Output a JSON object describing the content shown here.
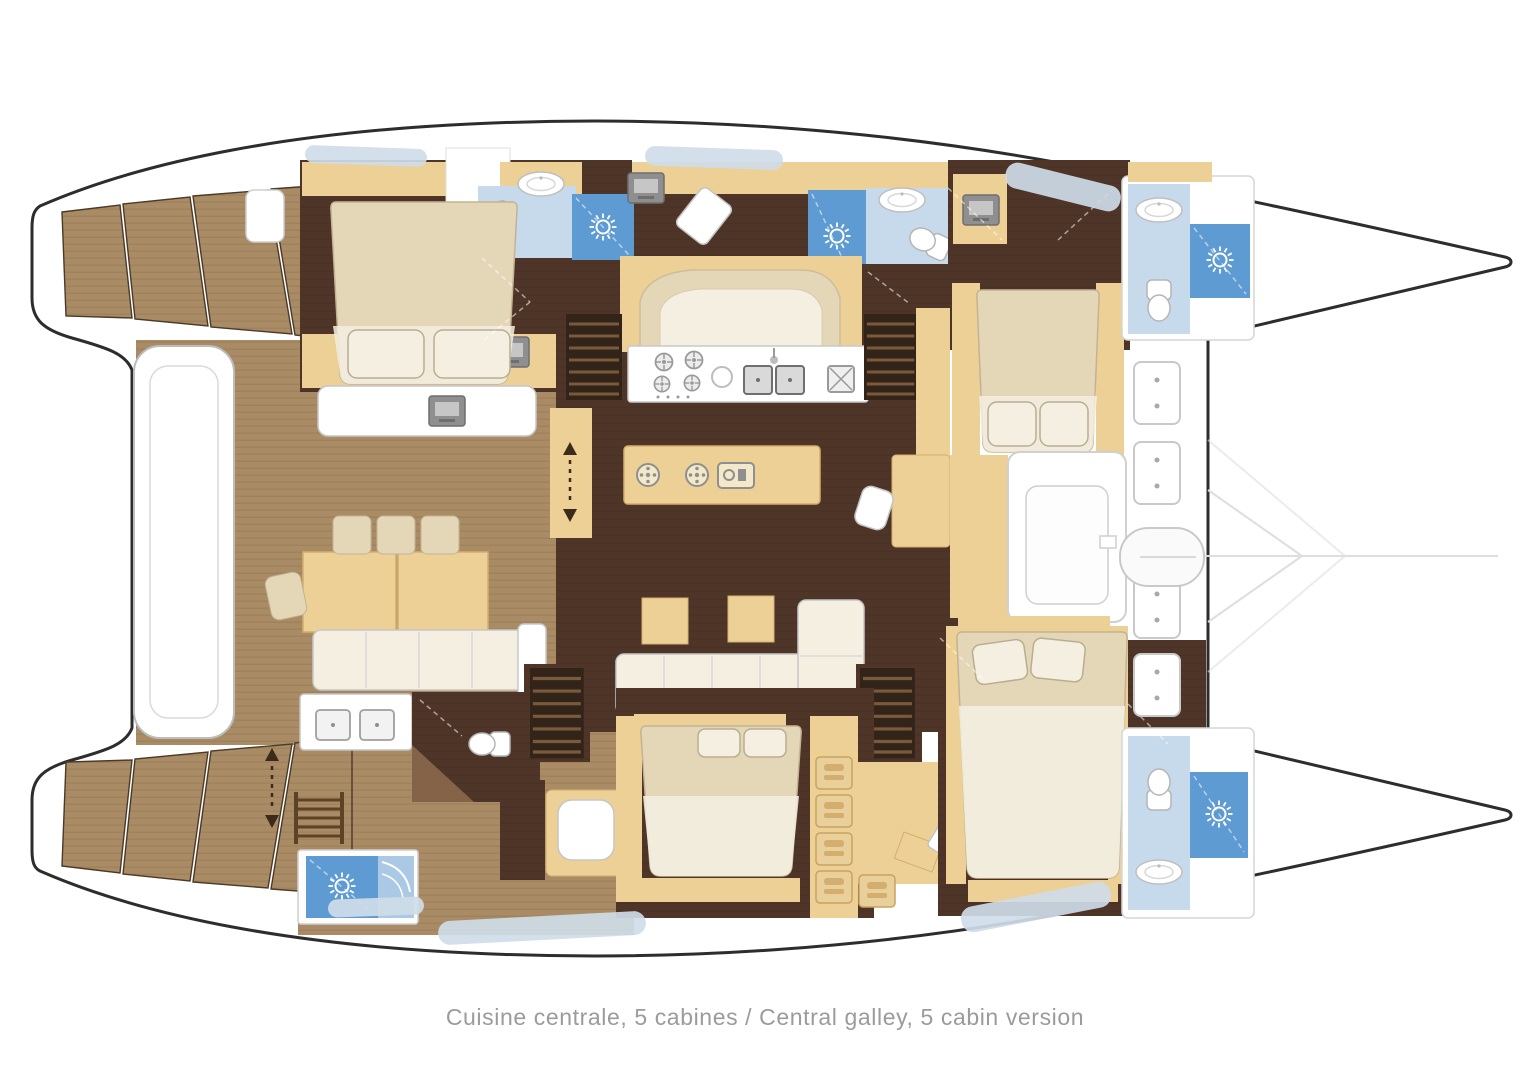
{
  "caption": {
    "text": "Cuisine centrale, 5 cabines / Central galley, 5 cabin version"
  },
  "plan": {
    "vessel": "catamaran deck plan",
    "galley": "central",
    "cabins": "5"
  },
  "palette": {
    "hull_outline": "#2d2d2d",
    "deck_wood": "#a98c66",
    "deck_wood_line": "#97794f",
    "cabin_floor": "#4f3528",
    "sand": "#ecd095",
    "sand_edge": "#d3ae6e",
    "cream": "#e4d7b8",
    "cream_light": "#f4efe0",
    "bath_blue_light": "#c7daec",
    "bath_blue_mid": "#abc8e4",
    "shower_blue": "#5f9bd3",
    "window_streak": "#cfdde9",
    "appliance_gray": "#8f8f8f",
    "outline_gray": "#c4c4c4",
    "caption_gray": "#9b9b9b"
  },
  "icons": {
    "shower-sun-icon": "white sun burst",
    "basin-icon": "white oval basin",
    "toilet-icon": "bowl with seat",
    "stove-icon": "four burners",
    "double-sink-icon": "twin squares with faucet",
    "deck-hatch-icon": "rounded square with two dots",
    "windlass-icon": "rounded capsule with anchor line",
    "stairs-icon": "dark treads",
    "ladder-icon": "rails and rungs",
    "drawer-icon": "sand front with handle",
    "tv-icon": "gray panel",
    "direction-track-icon": "dashed line with arrows"
  }
}
